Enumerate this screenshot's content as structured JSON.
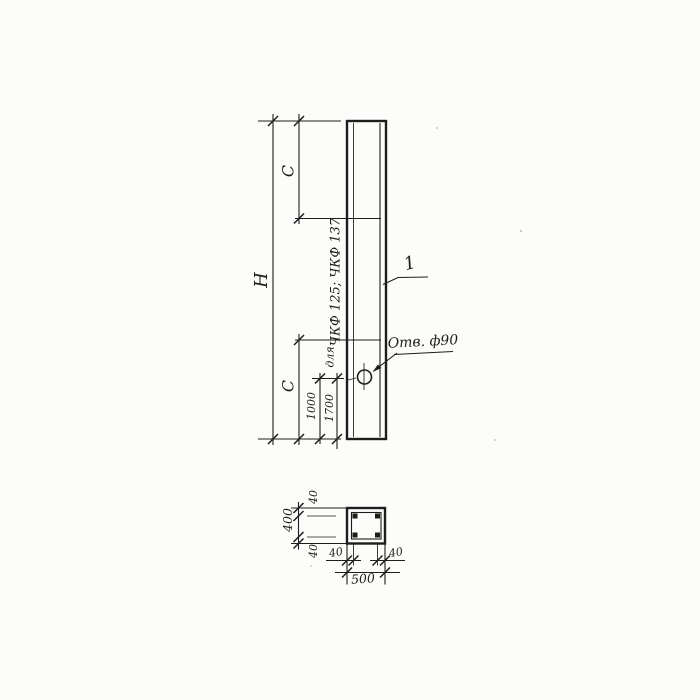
{
  "elevation": {
    "dim_h": "Н",
    "dim_c_top": "С",
    "dim_c_bottom": "С",
    "dim_1000": "1000",
    "dim_1700": "1700",
    "note_series": "ЧКФ 125; ЧКФ 137",
    "note_for": "для",
    "part_label": "1",
    "hole_label": "Отв. ф90"
  },
  "section": {
    "dim_width": "500",
    "dim_height": "400",
    "dim_cover_top": "40",
    "dim_cover_bottom": "40",
    "dim_cover_left": "40",
    "dim_cover_right": "40"
  },
  "colors": {
    "ink": "#1d1d1b",
    "paper": "#fcfcfb"
  }
}
